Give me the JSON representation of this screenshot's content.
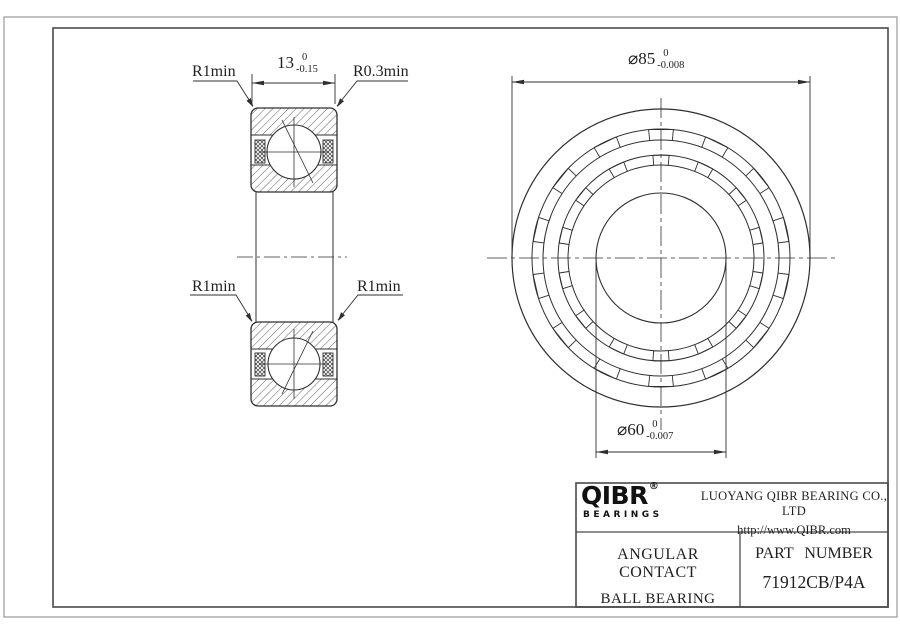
{
  "dims": {
    "width": {
      "main": "13",
      "tol_upper": "0",
      "tol_lower": "-0.15"
    },
    "outer_diameter": {
      "main": "⌀85",
      "tol_upper": "0",
      "tol_lower": "-0.008"
    },
    "bore_diameter": {
      "main": "⌀60",
      "tol_upper": "0",
      "tol_lower": "-0.007"
    }
  },
  "labels": {
    "radius_top_left": "R1min",
    "radius_top_right": "R0.3min",
    "radius_mid_left": "R1min",
    "radius_mid_right": "R1min"
  },
  "title_block": {
    "logo_text": "QIBR",
    "logo_registered": "®",
    "logo_subtext": "BEARINGS",
    "company_name": "LUOYANG QIBR BEARING CO., LTD",
    "company_url": "http://www.QIBR.com",
    "product_type_line1": "ANGULAR CONTACT",
    "product_type_line2": "BALL BEARING",
    "part_number_label": "PART NUMBER",
    "part_number_value": "71912CB/P4A"
  },
  "colors": {
    "line": "#2f2f2f",
    "frame": "#4a4a4a",
    "page_border": "#9a9a9a",
    "text": "#1f1f1f",
    "logo": "#121212"
  }
}
